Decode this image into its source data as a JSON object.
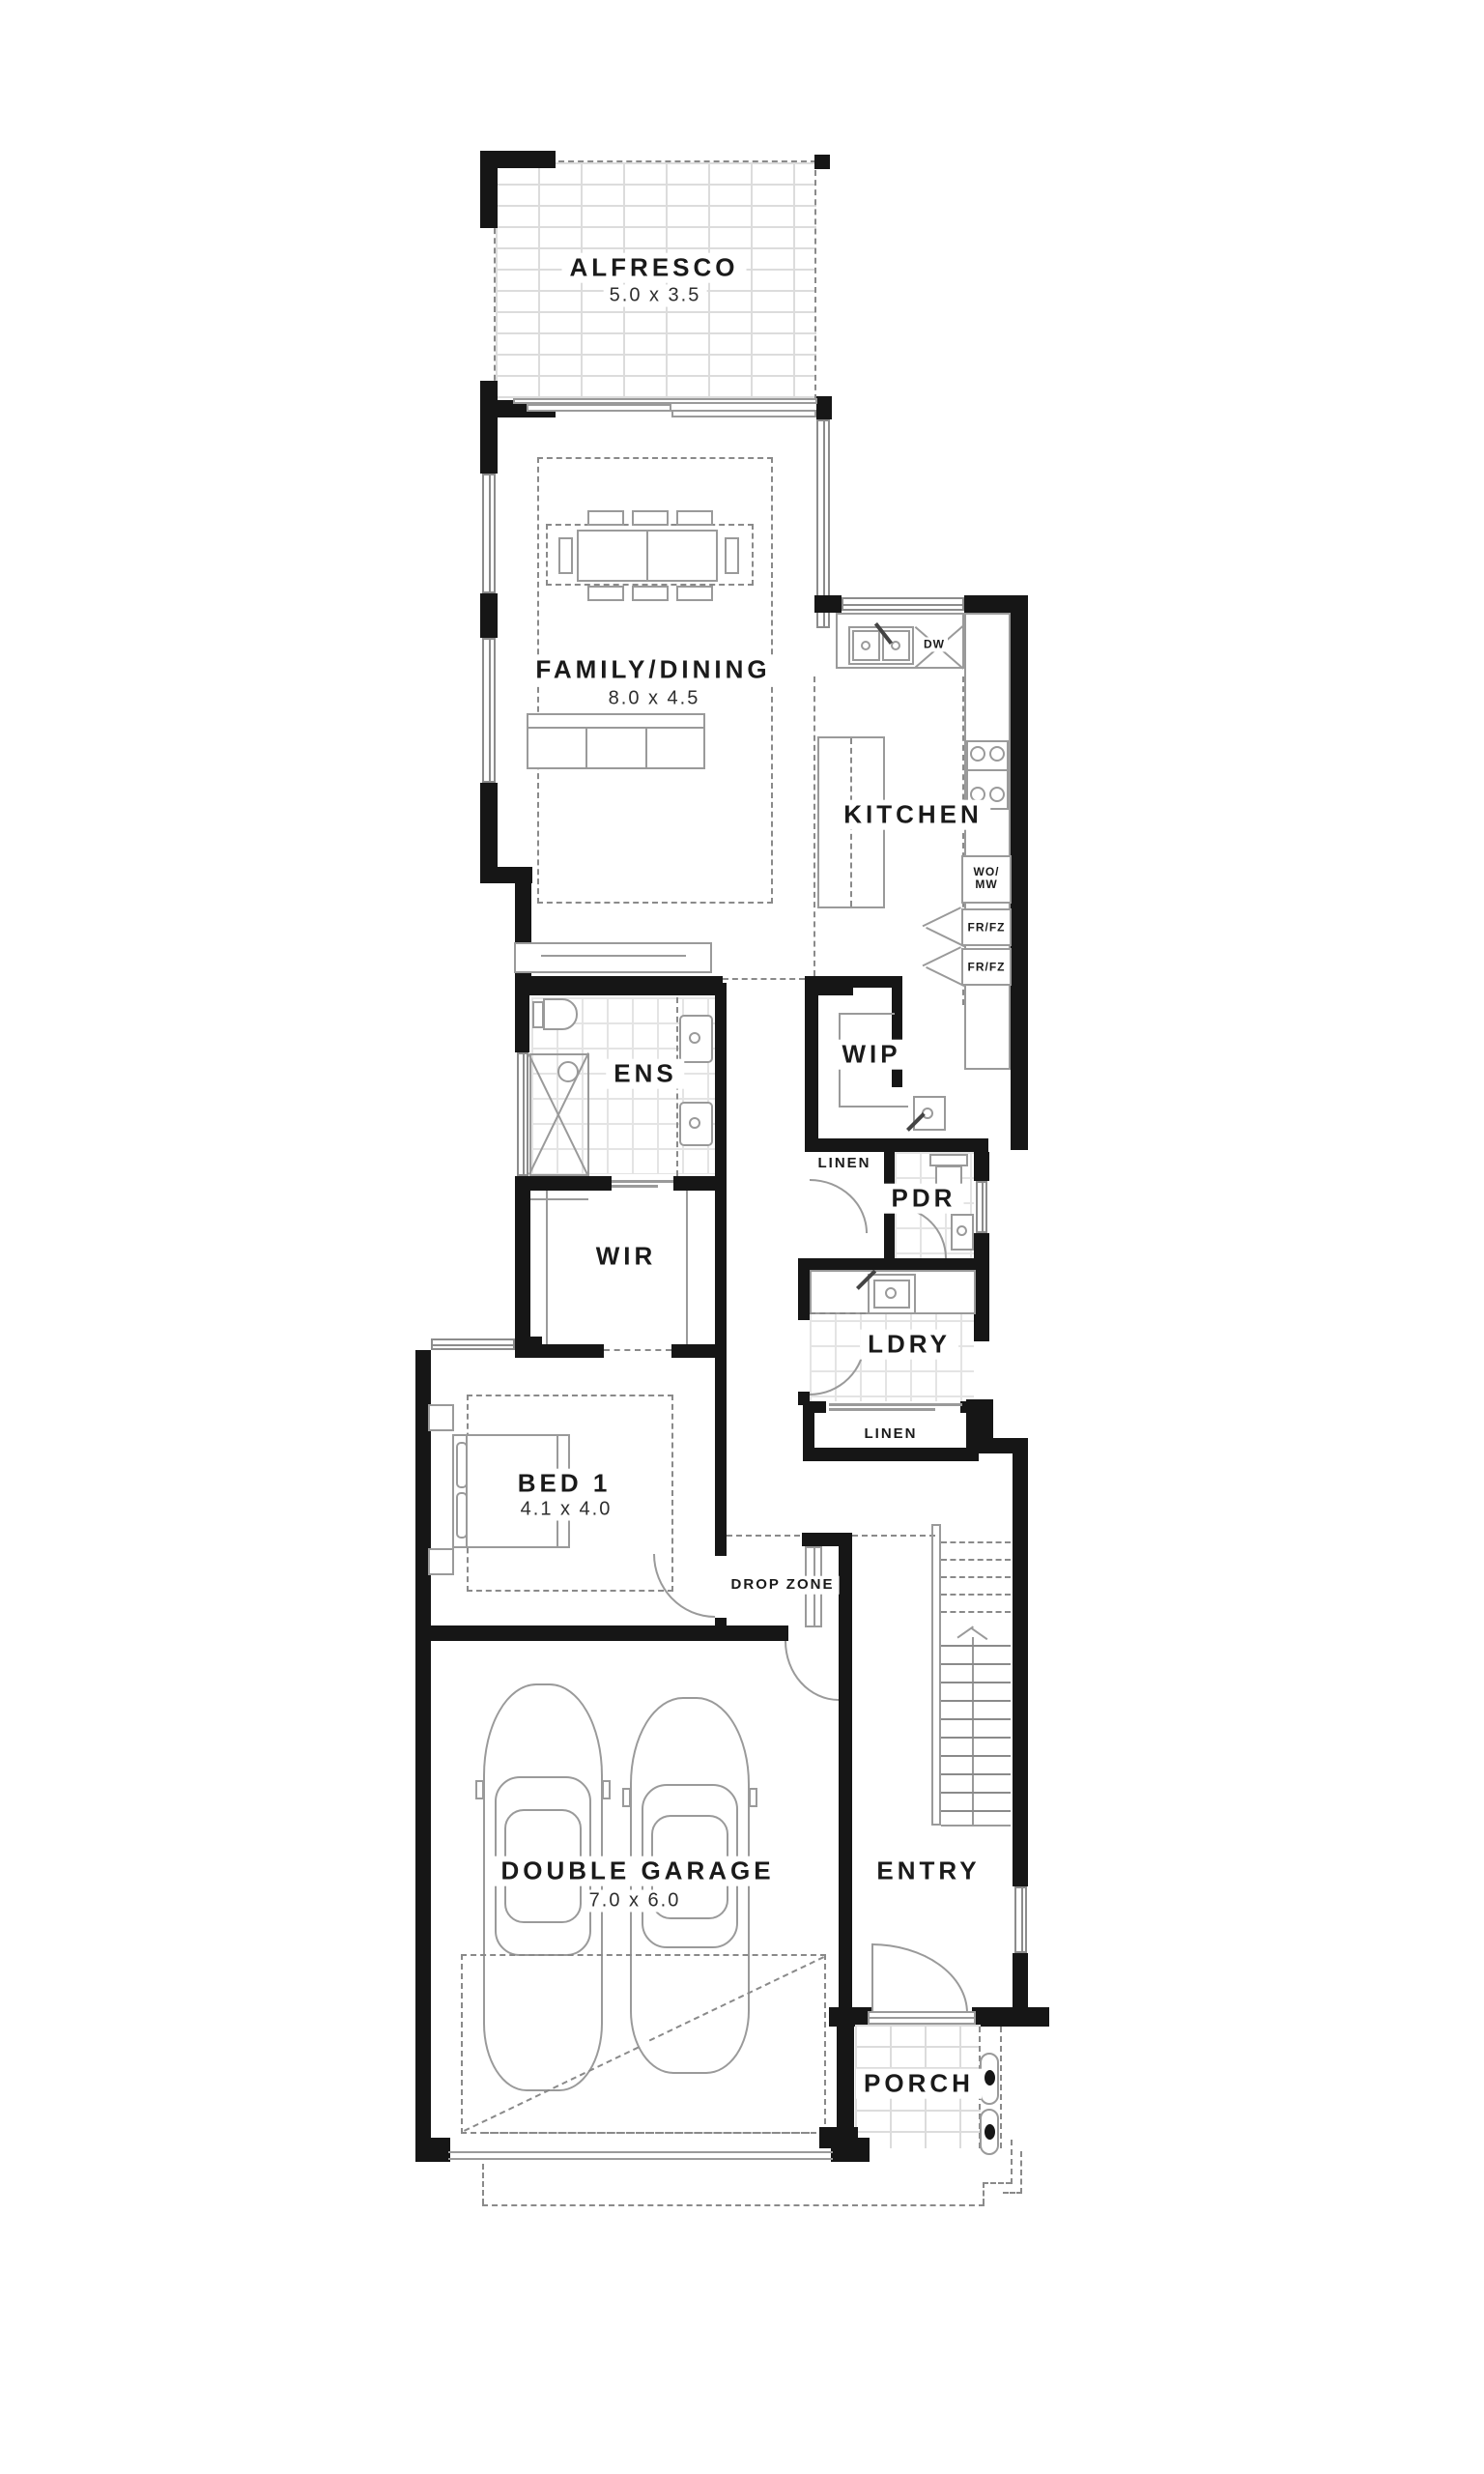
{
  "rooms": {
    "alfresco": {
      "name": "ALFRESCO",
      "size": "5.0 x 3.5"
    },
    "family_dining": {
      "name": "FAMILY/DINING",
      "size": "8.0 x 4.5"
    },
    "kitchen": {
      "name": "KITCHEN"
    },
    "ens": {
      "name": "ENS"
    },
    "wip": {
      "name": "WIP"
    },
    "linen_upper": {
      "name": "LINEN"
    },
    "pdr": {
      "name": "PDR"
    },
    "wir": {
      "name": "WIR"
    },
    "ldry": {
      "name": "LDRY"
    },
    "linen_lower": {
      "name": "LINEN"
    },
    "bed1": {
      "name": "BED 1",
      "size": "4.1 x 4.0"
    },
    "drop_zone": {
      "name": "DROP ZONE"
    },
    "garage": {
      "name": "DOUBLE GARAGE",
      "size": "7.0 x 6.0"
    },
    "entry": {
      "name": "ENTRY"
    },
    "porch": {
      "name": "PORCH"
    }
  },
  "appliances": {
    "dishwasher": "DW",
    "wall_oven_microwave": "WO/\nMW",
    "fridge_freezer_1": "FR/FZ",
    "fridge_freezer_2": "FR/FZ"
  }
}
